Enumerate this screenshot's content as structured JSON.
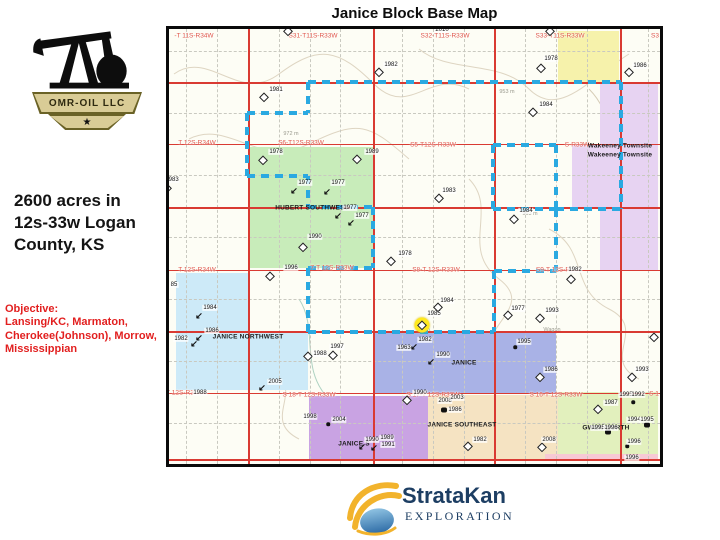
{
  "header": {
    "title": "Janice Block Base Map"
  },
  "logo": {
    "company": "OMR-OIL LLC",
    "star": "★"
  },
  "left_panel": {
    "acreage": "2600 acres in\n12s-33w Logan\nCounty, KS",
    "objective": "Objective:\nLansing/KC, Marmaton,\nCherokee(Johnson), Morrow,\nMississippian"
  },
  "footer": {
    "brand": "StrataKan",
    "sub": "EXPLORATION"
  },
  "map": {
    "colors": {
      "red_line": "#d93a32",
      "red_label": "#e0564a",
      "dash_blue": "#2aa9e1",
      "grid_gray": "#c9c9c0"
    },
    "parcels": [
      {
        "n": "yellow-north",
        "x": 558,
        "y": 31,
        "w": 61,
        "h": 51,
        "c": "#f6f2ab"
      },
      {
        "n": "wakeeney-townsite",
        "x": 600,
        "y": 84,
        "w": 58,
        "h": 187,
        "c": "#e7d3f2"
      },
      {
        "n": "wakeeney-townsite-west",
        "x": 572,
        "y": 144,
        "w": 28,
        "h": 65,
        "c": "#e7d3f2"
      },
      {
        "n": "hubert-southwest",
        "x": 250,
        "y": 147,
        "w": 123,
        "h": 121,
        "c": "#c8ecba"
      },
      {
        "n": "janice-northwest-upper",
        "x": 176,
        "y": 273,
        "w": 74,
        "h": 58,
        "c": "#cdeaf8"
      },
      {
        "n": "janice-northwest-lower",
        "x": 176,
        "y": 331,
        "w": 132,
        "h": 59,
        "c": "#cdeaf8"
      },
      {
        "n": "janice",
        "x": 374,
        "y": 333,
        "w": 182,
        "h": 60,
        "c": "#a9b2e6"
      },
      {
        "n": "janice-south",
        "x": 309,
        "y": 396,
        "w": 119,
        "h": 64,
        "c": "#c9a3e3"
      },
      {
        "n": "janice-southeast",
        "x": 428,
        "y": 395,
        "w": 130,
        "h": 65,
        "c": "#f5e3c2"
      },
      {
        "n": "gwen-north",
        "x": 558,
        "y": 392,
        "w": 100,
        "h": 62,
        "c": "#e2f0bd"
      },
      {
        "n": "south-strip",
        "x": 545,
        "y": 454,
        "w": 113,
        "h": 7,
        "c": "#f7c9d4"
      }
    ],
    "gray_v": [
      186,
      217,
      279,
      310,
      340,
      402,
      433,
      464,
      525,
      556,
      587,
      648
    ],
    "gray_h": [
      51,
      113,
      175,
      237,
      299,
      361,
      423
    ],
    "red_h": [
      {
        "y": 82,
        "w": 2
      },
      {
        "y": 144,
        "w": 1
      },
      {
        "y": 207,
        "w": 2
      },
      {
        "y": 270,
        "w": 1
      },
      {
        "y": 331,
        "w": 2
      },
      {
        "y": 393,
        "w": 1
      },
      {
        "y": 459,
        "w": 2
      }
    ],
    "red_v": [
      {
        "x": 248,
        "w": 2
      },
      {
        "x": 373,
        "w": 2
      },
      {
        "x": 494,
        "w": 2
      },
      {
        "x": 620,
        "w": 2
      }
    ],
    "dash_segments": [
      {
        "o": "h",
        "p": 82,
        "a": 308,
        "b": 621
      },
      {
        "o": "v",
        "p": 308,
        "a": 82,
        "b": 113
      },
      {
        "o": "h",
        "p": 113,
        "a": 247,
        "b": 308
      },
      {
        "o": "v",
        "p": 247,
        "a": 113,
        "b": 176
      },
      {
        "o": "h",
        "p": 176,
        "a": 247,
        "b": 308
      },
      {
        "o": "v",
        "p": 308,
        "a": 176,
        "b": 207
      },
      {
        "o": "h",
        "p": 207,
        "a": 308,
        "b": 373
      },
      {
        "o": "v",
        "p": 373,
        "a": 207,
        "b": 268
      },
      {
        "o": "h",
        "p": 268,
        "a": 308,
        "b": 373
      },
      {
        "o": "v",
        "p": 308,
        "a": 268,
        "b": 332
      },
      {
        "o": "h",
        "p": 332,
        "a": 308,
        "b": 494
      },
      {
        "o": "v",
        "p": 494,
        "a": 271,
        "b": 332
      },
      {
        "o": "h",
        "p": 271,
        "a": 494,
        "b": 556
      },
      {
        "o": "v",
        "p": 556,
        "a": 209,
        "b": 271
      },
      {
        "o": "h",
        "p": 209,
        "a": 556,
        "b": 621
      },
      {
        "o": "v",
        "p": 621,
        "a": 82,
        "b": 209
      },
      {
        "o": "v",
        "p": 493,
        "a": 145,
        "b": 209
      },
      {
        "o": "v",
        "p": 556,
        "a": 145,
        "b": 209
      },
      {
        "o": "h",
        "p": 145,
        "a": 493,
        "b": 556
      },
      {
        "o": "h",
        "p": 209,
        "a": 493,
        "b": 556
      }
    ],
    "section_labels": [
      {
        "t": "-T 11S-R34W",
        "x": 194,
        "y": 36
      },
      {
        "t": "S31-T11S-R33W",
        "x": 313,
        "y": 36
      },
      {
        "t": "S32-T11S-R33W",
        "x": 445,
        "y": 36
      },
      {
        "t": "S33-T11S-R33W",
        "x": 560,
        "y": 36
      },
      {
        "t": "S3",
        "x": 655,
        "y": 36
      },
      {
        "t": "T 12S-R34W",
        "x": 197,
        "y": 143
      },
      {
        "t": "S6-T12S-R33W",
        "x": 301,
        "y": 143
      },
      {
        "t": "S5-T12S-R33W",
        "x": 433,
        "y": 145
      },
      {
        "t": "S-R33W",
        "x": 577,
        "y": 145
      },
      {
        "t": "T 12S-R34W",
        "x": 197,
        "y": 270
      },
      {
        "t": "7-T 12S-R33W",
        "x": 332,
        "y": 268
      },
      {
        "t": "S8-T 12S-R33W",
        "x": 436,
        "y": 270
      },
      {
        "t": "S9-T 12S-R",
        "x": 553,
        "y": 270
      },
      {
        "t": "T 12S-R3",
        "x": 180,
        "y": 393
      },
      {
        "t": "S 18-T 12S-R33W",
        "x": 309,
        "y": 395
      },
      {
        "t": "S 17-T 12S-R33W",
        "x": 433,
        "y": 395
      },
      {
        "t": "S 16-T 12S-R33W",
        "x": 556,
        "y": 395
      },
      {
        "t": "S 1",
        "x": 654,
        "y": 394
      }
    ],
    "place_labels": [
      {
        "t": "HUBERT SOUTHWEST",
        "x": 312,
        "y": 208
      },
      {
        "t": "JANICE NORTHWEST",
        "x": 248,
        "y": 337
      },
      {
        "t": "JANICE",
        "x": 464,
        "y": 363
      },
      {
        "t": "JANICE S",
        "x": 354,
        "y": 444
      },
      {
        "t": "JANICE SOUTHEAST",
        "x": 462,
        "y": 425
      },
      {
        "t": "GWEN NORTH",
        "x": 606,
        "y": 428
      },
      {
        "t": "Wakeeney Townsite",
        "x": 620,
        "y": 146
      },
      {
        "t": "Wakeeney Townsite",
        "x": 620,
        "y": 155
      }
    ],
    "contour_labels": [
      {
        "t": "972 m",
        "x": 291,
        "y": 134
      },
      {
        "t": "953 m",
        "x": 507,
        "y": 92
      },
      {
        "t": "963 m",
        "x": 530,
        "y": 214
      },
      {
        "t": "Wagon",
        "x": 552,
        "y": 330
      }
    ],
    "wells": [
      {
        "t": "1982",
        "x": 391,
        "y": 65,
        "s": "d",
        "sx": 379,
        "sy": 72
      },
      {
        "t": "1981",
        "x": 276,
        "y": 90,
        "s": "d",
        "sx": 264,
        "sy": 97
      },
      {
        "t": "1978",
        "x": 276,
        "y": 152,
        "s": "d",
        "sx": 263,
        "sy": 160
      },
      {
        "t": "1989",
        "x": 372,
        "y": 152,
        "s": "d",
        "sx": 357,
        "sy": 159
      },
      {
        "t": "1983",
        "x": 172,
        "y": 180,
        "s": "d",
        "sx": 167,
        "sy": 188
      },
      {
        "t": "1978",
        "x": 551,
        "y": 59,
        "s": "d",
        "sx": 541,
        "sy": 68
      },
      {
        "t": "1986",
        "x": 640,
        "y": 66,
        "s": "d",
        "sx": 629,
        "sy": 72
      },
      {
        "t": "1984",
        "x": 546,
        "y": 105,
        "s": "d",
        "sx": 533,
        "sy": 112
      },
      {
        "t": "1983",
        "x": 449,
        "y": 191,
        "s": "d",
        "sx": 439,
        "sy": 198
      },
      {
        "t": "1984",
        "x": 526,
        "y": 211,
        "s": "d",
        "sx": 514,
        "sy": 219
      },
      {
        "t": "1977",
        "x": 305,
        "y": 183,
        "s": "a",
        "sx": 294,
        "sy": 191
      },
      {
        "t": "1977",
        "x": 338,
        "y": 183,
        "s": "a",
        "sx": 327,
        "sy": 192
      },
      {
        "t": "1977",
        "x": 350,
        "y": 208,
        "s": "a",
        "sx": 338,
        "sy": 216
      },
      {
        "t": "1977",
        "x": 362,
        "y": 216,
        "s": "a",
        "sx": 351,
        "sy": 223
      },
      {
        "t": "1990",
        "x": 315,
        "y": 237,
        "s": "d",
        "sx": 303,
        "sy": 247
      },
      {
        "t": "1978",
        "x": 405,
        "y": 254,
        "s": "d",
        "sx": 391,
        "sy": 261
      },
      {
        "t": "1982",
        "x": 575,
        "y": 270,
        "s": "d",
        "sx": 571,
        "sy": 279
      },
      {
        "t": "1984",
        "x": 210,
        "y": 308,
        "s": "a",
        "sx": 199,
        "sy": 316
      },
      {
        "t": "1986",
        "x": 212,
        "y": 331,
        "s": "a",
        "sx": 199,
        "sy": 338
      },
      {
        "t": "1982",
        "x": 181,
        "y": 339,
        "s": "a",
        "sx": 194,
        "sy": 344
      },
      {
        "t": "2005",
        "x": 275,
        "y": 382,
        "s": "a",
        "sx": 262,
        "sy": 388
      },
      {
        "t": "1997",
        "x": 337,
        "y": 347,
        "s": "d",
        "sx": 333,
        "sy": 355
      },
      {
        "t": "1988",
        "x": 320,
        "y": 354,
        "s": "d",
        "sx": 308,
        "sy": 356
      },
      {
        "t": "1985",
        "x": 434,
        "y": 314,
        "s": "d",
        "sx": 422,
        "sy": 325,
        "h": 1
      },
      {
        "t": "1984",
        "x": 447,
        "y": 301,
        "s": "d",
        "sx": 438,
        "sy": 307
      },
      {
        "t": "1977",
        "x": 518,
        "y": 309,
        "s": "d",
        "sx": 508,
        "sy": 315
      },
      {
        "t": "1993",
        "x": 552,
        "y": 311,
        "s": "d",
        "sx": 540,
        "sy": 318
      },
      {
        "t": "1995",
        "x": 524,
        "y": 342,
        "s": "o",
        "sx": 515,
        "sy": 347
      },
      {
        "t": "1986",
        "x": 551,
        "y": 370,
        "s": "d",
        "sx": 540,
        "sy": 377
      },
      {
        "t": "1993",
        "x": 642,
        "y": 370,
        "s": "d",
        "sx": 632,
        "sy": 377
      },
      {
        "t": "1963",
        "x": 404,
        "y": 348,
        "s": ""
      },
      {
        "t": "1982",
        "x": 425,
        "y": 340,
        "s": "a",
        "sx": 414,
        "sy": 347
      },
      {
        "t": "1990",
        "x": 443,
        "y": 355,
        "s": "a",
        "sx": 431,
        "sy": 362
      },
      {
        "t": "1998",
        "x": 310,
        "y": 417,
        "s": ""
      },
      {
        "t": "2004",
        "x": 339,
        "y": 420,
        "s": "o",
        "sx": 328,
        "sy": 424
      },
      {
        "t": "1990",
        "x": 372,
        "y": 440,
        "s": "a",
        "sx": 362,
        "sy": 447
      },
      {
        "t": "1989",
        "x": 387,
        "y": 438,
        "s": "a",
        "sx": 374,
        "sy": 448
      },
      {
        "t": "1991",
        "x": 388,
        "y": 445,
        "s": ""
      },
      {
        "t": "2008",
        "x": 445,
        "y": 401,
        "s": ""
      },
      {
        "t": "2003",
        "x": 457,
        "y": 398,
        "s": ""
      },
      {
        "t": "1986",
        "x": 455,
        "y": 410,
        "s": "b",
        "sx": 444,
        "sy": 410
      },
      {
        "t": "1982",
        "x": 480,
        "y": 440,
        "s": "d",
        "sx": 468,
        "sy": 446
      },
      {
        "t": "2008",
        "x": 549,
        "y": 440,
        "s": "d",
        "sx": 542,
        "sy": 447
      },
      {
        "t": "1987",
        "x": 611,
        "y": 403,
        "s": "d",
        "sx": 598,
        "sy": 409
      },
      {
        "t": "1995",
        "x": 626,
        "y": 395,
        "s": ""
      },
      {
        "t": "1992",
        "x": 638,
        "y": 395,
        "s": "o",
        "sx": 633,
        "sy": 402
      },
      {
        "t": "1994",
        "x": 634,
        "y": 420,
        "s": ""
      },
      {
        "t": "1995",
        "x": 647,
        "y": 420,
        "s": "b",
        "sx": 647,
        "sy": 425
      },
      {
        "t": "1995",
        "x": 598,
        "y": 428,
        "s": ""
      },
      {
        "t": "1996",
        "x": 611,
        "y": 428,
        "s": "b",
        "sx": 608,
        "sy": 432
      },
      {
        "t": "1996",
        "x": 634,
        "y": 442,
        "s": "o",
        "sx": 627,
        "sy": 446
      },
      {
        "t": "1996",
        "x": 632,
        "y": 458,
        "s": ""
      },
      {
        "t": "",
        "s": "d",
        "sx": 654,
        "sy": 337
      },
      {
        "t": "",
        "s": "d",
        "sx": 407,
        "sy": 400
      },
      {
        "t": "",
        "s": "d",
        "sx": 270,
        "sy": 276
      },
      {
        "t": "",
        "s": "d",
        "sx": 550,
        "sy": 31
      },
      {
        "t": "",
        "s": "d",
        "sx": 288,
        "sy": 31
      },
      {
        "t": "2010",
        "x": 442,
        "y": 30,
        "s": ""
      },
      {
        "t": "1996",
        "x": 291,
        "y": 268,
        "s": ""
      },
      {
        "t": "1988",
        "x": 200,
        "y": 393,
        "s": ""
      },
      {
        "t": "1990",
        "x": 420,
        "y": 393,
        "s": ""
      },
      {
        "t": "85",
        "x": 174,
        "y": 285,
        "s": ""
      }
    ]
  }
}
